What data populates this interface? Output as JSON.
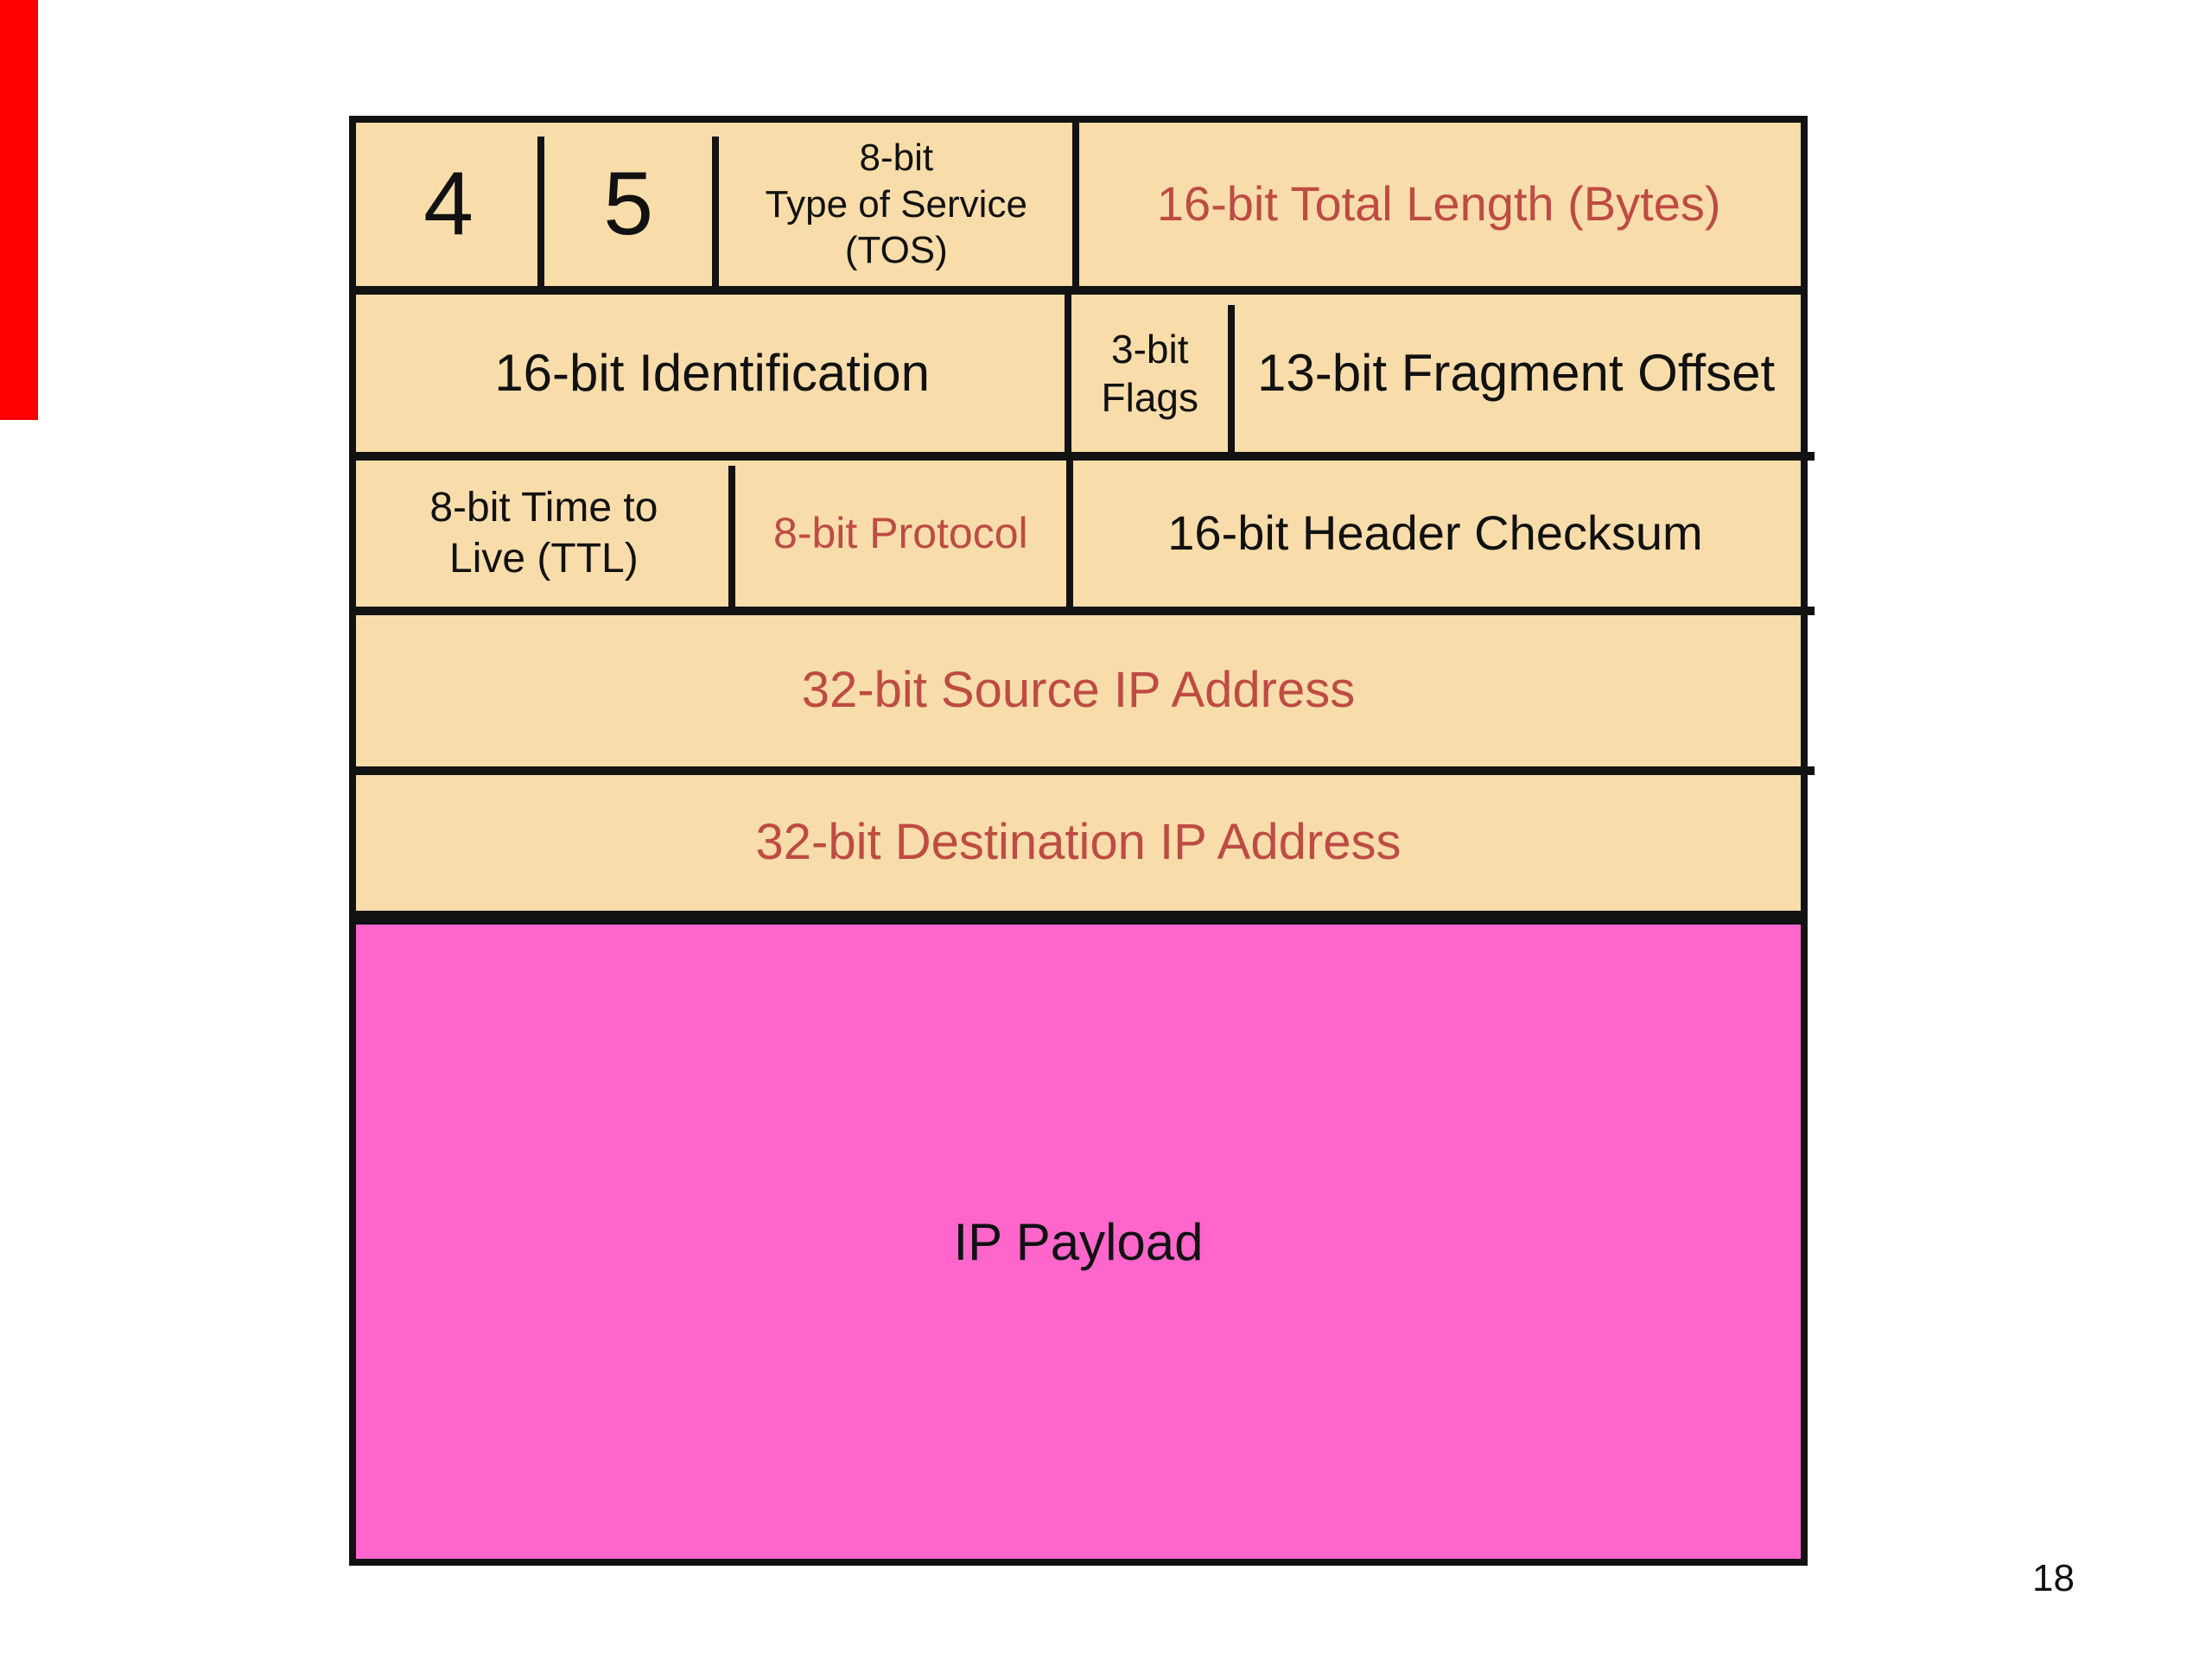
{
  "page": {
    "background": "#FFFFFF",
    "page_number": "18"
  },
  "marker": {
    "color": "#FF0000"
  },
  "colors": {
    "cell_fill": "#F8DDAA",
    "payload_fill": "#FF66CC",
    "accent_red_text": "#BE4B44",
    "line_black": "#121212"
  },
  "ipv4_header": {
    "rows": [
      {
        "cells": [
          {
            "lines": [
              "4"
            ]
          },
          {
            "lines": [
              "5"
            ]
          },
          {
            "lines": [
              "8-bit",
              "Type of Service",
              "(TOS)"
            ]
          },
          {
            "lines": [
              "16-bit Total Length (Bytes)"
            ],
            "red": true
          }
        ]
      },
      {
        "cells": [
          {
            "lines": [
              "16-bit Identification"
            ]
          },
          {
            "lines": [
              "3-bit",
              "Flags"
            ]
          },
          {
            "lines": [
              "13-bit Fragment Offset"
            ]
          }
        ]
      },
      {
        "cells": [
          {
            "lines": [
              "8-bit Time to",
              "Live (TTL)"
            ]
          },
          {
            "lines": [
              "8-bit Protocol"
            ],
            "red": true
          },
          {
            "lines": [
              "16-bit Header Checksum"
            ]
          }
        ]
      },
      {
        "cells": [
          {
            "lines": [
              "32-bit Source IP Address"
            ],
            "red": true
          }
        ]
      },
      {
        "cells": [
          {
            "lines": [
              "32-bit Destination IP Address"
            ],
            "red": true
          }
        ]
      }
    ],
    "payload_label": "IP Payload"
  }
}
